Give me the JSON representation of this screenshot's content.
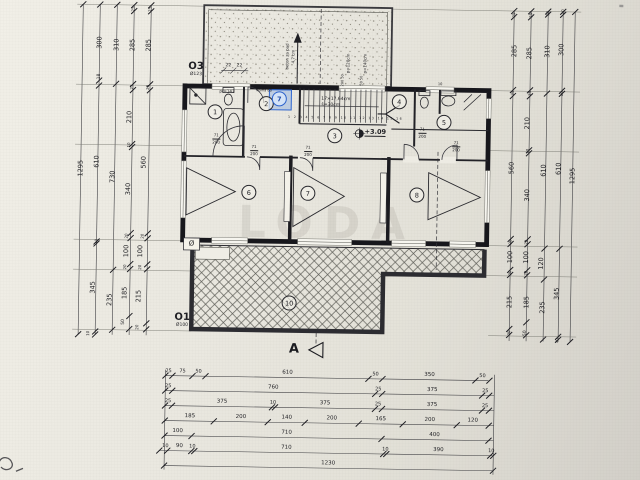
{
  "watermark": "LODA",
  "section_marker": "A",
  "openings": {
    "o3": {
      "label": "O3",
      "size": "Ø123"
    },
    "o1": {
      "label": "O1",
      "size": "Ø100"
    }
  },
  "plan_notes": {
    "stair_run": "17×17,64cm",
    "stair_width": "š=30cm",
    "elevation": "+3.09",
    "slope_note": "beton za pad 4,7 cm",
    "door_tag": "71/200"
  },
  "rooms": [
    {
      "n": "1",
      "x": 213,
      "y": 113
    },
    {
      "n": "2",
      "x": 264,
      "y": 104
    },
    {
      "n": "7",
      "x": 277,
      "y": 99,
      "sel": true
    },
    {
      "n": "3",
      "x": 333,
      "y": 135
    },
    {
      "n": "4",
      "x": 397,
      "y": 100
    },
    {
      "n": "5",
      "x": 442,
      "y": 120
    },
    {
      "n": "6",
      "x": 248,
      "y": 193
    },
    {
      "n": "7",
      "x": 307,
      "y": 193
    },
    {
      "n": "8",
      "x": 416,
      "y": 193
    },
    {
      "n": "10",
      "x": 290,
      "y": 303
    }
  ],
  "labels": [
    {
      "t": "1295",
      "x": 80,
      "y": 172,
      "o": "v"
    },
    {
      "t": "300",
      "x": 97,
      "y": 46,
      "o": "v"
    },
    {
      "t": "18",
      "x": 98,
      "y": 80,
      "o": "v",
      "fs": 4.5
    },
    {
      "t": "610",
      "x": 96,
      "y": 165,
      "o": "v"
    },
    {
      "t": "10",
      "x": 97,
      "y": 245,
      "o": "v",
      "fs": 4
    },
    {
      "t": "345",
      "x": 94,
      "y": 291,
      "o": "v"
    },
    {
      "t": "10",
      "x": 90,
      "y": 337,
      "o": "v",
      "fs": 4
    },
    {
      "t": "310",
      "x": 114,
      "y": 48,
      "o": "v"
    },
    {
      "t": "730",
      "x": 112,
      "y": 180,
      "o": "v"
    },
    {
      "t": "235",
      "x": 111,
      "y": 303,
      "o": "v"
    },
    {
      "t": "25",
      "x": 130,
      "y": 12,
      "o": "v",
      "fs": 4
    },
    {
      "t": "285",
      "x": 130,
      "y": 48,
      "o": "v"
    },
    {
      "t": "25",
      "x": 130,
      "y": 90,
      "o": "v",
      "fs": 4
    },
    {
      "t": "210",
      "x": 128,
      "y": 120,
      "o": "v"
    },
    {
      "t": "10",
      "x": 128,
      "y": 148,
      "o": "v",
      "fs": 4
    },
    {
      "t": "340",
      "x": 128,
      "y": 192,
      "o": "v"
    },
    {
      "t": "20",
      "x": 127,
      "y": 239,
      "o": "v",
      "fs": 4
    },
    {
      "t": "100",
      "x": 127,
      "y": 254,
      "o": "v"
    },
    {
      "t": "20",
      "x": 126,
      "y": 270,
      "o": "v",
      "fs": 4
    },
    {
      "t": "185",
      "x": 126,
      "y": 296,
      "o": "v"
    },
    {
      "t": "50",
      "x": 126,
      "y": 325,
      "o": "v",
      "fs": 4.5
    },
    {
      "t": "25",
      "x": 147,
      "y": 12,
      "o": "v",
      "fs": 4
    },
    {
      "t": "285",
      "x": 146,
      "y": 48,
      "o": "v"
    },
    {
      "t": "25",
      "x": 146,
      "y": 90,
      "o": "v",
      "fs": 4
    },
    {
      "t": "560",
      "x": 143,
      "y": 165,
      "o": "v"
    },
    {
      "t": "20",
      "x": 143,
      "y": 239,
      "o": "v",
      "fs": 4
    },
    {
      "t": "100",
      "x": 141,
      "y": 254,
      "o": "v"
    },
    {
      "t": "20",
      "x": 141,
      "y": 270,
      "o": "v",
      "fs": 4
    },
    {
      "t": "215",
      "x": 140,
      "y": 299,
      "o": "v"
    },
    {
      "t": "20",
      "x": 139,
      "y": 330,
      "o": "v",
      "fs": 4
    },
    {
      "t": "25",
      "x": 511,
      "y": 12,
      "o": "v",
      "fs": 4
    },
    {
      "t": "285",
      "x": 512,
      "y": 48,
      "o": "v"
    },
    {
      "t": "25",
      "x": 511,
      "y": 90,
      "o": "v",
      "fs": 4
    },
    {
      "t": "560",
      "x": 511,
      "y": 165,
      "o": "v"
    },
    {
      "t": "20",
      "x": 511,
      "y": 239,
      "o": "v",
      "fs": 4
    },
    {
      "t": "100",
      "x": 511,
      "y": 254,
      "o": "v"
    },
    {
      "t": "20",
      "x": 511,
      "y": 270,
      "o": "v",
      "fs": 4
    },
    {
      "t": "215",
      "x": 511,
      "y": 299,
      "o": "v"
    },
    {
      "t": "20",
      "x": 511,
      "y": 330,
      "o": "v",
      "fs": 4
    },
    {
      "t": "25",
      "x": 528,
      "y": 12,
      "o": "v",
      "fs": 4
    },
    {
      "t": "285",
      "x": 527,
      "y": 50,
      "o": "v"
    },
    {
      "t": "25",
      "x": 528,
      "y": 90,
      "o": "v",
      "fs": 4
    },
    {
      "t": "210",
      "x": 526,
      "y": 120,
      "o": "v"
    },
    {
      "t": "10",
      "x": 527,
      "y": 148,
      "o": "v",
      "fs": 4
    },
    {
      "t": "340",
      "x": 527,
      "y": 192,
      "o": "v"
    },
    {
      "t": "20",
      "x": 527,
      "y": 239,
      "o": "v",
      "fs": 4
    },
    {
      "t": "100",
      "x": 527,
      "y": 254,
      "o": "v"
    },
    {
      "t": "20",
      "x": 527,
      "y": 270,
      "o": "v",
      "fs": 4
    },
    {
      "t": "185",
      "x": 528,
      "y": 299,
      "o": "v"
    },
    {
      "t": "50",
      "x": 528,
      "y": 330,
      "o": "v",
      "fs": 4.5
    },
    {
      "t": "10",
      "x": 545,
      "y": 10,
      "o": "v",
      "fs": 4
    },
    {
      "t": "310",
      "x": 545,
      "y": 48,
      "o": "v"
    },
    {
      "t": "610",
      "x": 543,
      "y": 167,
      "o": "v"
    },
    {
      "t": "120",
      "x": 542,
      "y": 260,
      "o": "v"
    },
    {
      "t": "235",
      "x": 544,
      "y": 304,
      "o": "v"
    },
    {
      "t": "10",
      "x": 560,
      "y": 8,
      "o": "v",
      "fs": 4
    },
    {
      "t": "300",
      "x": 559,
      "y": 46,
      "o": "v"
    },
    {
      "t": "10",
      "x": 560,
      "y": 90,
      "o": "v",
      "fs": 4
    },
    {
      "t": "610",
      "x": 558,
      "y": 165,
      "o": "v"
    },
    {
      "t": "345",
      "x": 558,
      "y": 290,
      "o": "v"
    },
    {
      "t": "10",
      "x": 559,
      "y": 337,
      "o": "v",
      "fs": 4
    },
    {
      "t": "1295",
      "x": 572,
      "y": 172,
      "o": "v"
    },
    {
      "t": "25",
      "x": 171,
      "y": 374,
      "fs": 5
    },
    {
      "t": "75",
      "x": 185,
      "y": 374,
      "fs": 5
    },
    {
      "t": "50",
      "x": 201,
      "y": 374,
      "fs": 5
    },
    {
      "t": "610",
      "x": 290,
      "y": 374,
      "fs": 5.5
    },
    {
      "t": "50",
      "x": 378,
      "y": 374,
      "fs": 5
    },
    {
      "t": "350",
      "x": 432,
      "y": 374,
      "fs": 5.5
    },
    {
      "t": "50",
      "x": 485,
      "y": 374,
      "fs": 5
    },
    {
      "t": "25",
      "x": 171,
      "y": 389,
      "fs": 5
    },
    {
      "t": "760",
      "x": 276,
      "y": 389,
      "fs": 5.5
    },
    {
      "t": "25",
      "x": 381,
      "y": 389,
      "fs": 5
    },
    {
      "t": "375",
      "x": 435,
      "y": 389,
      "fs": 5.5
    },
    {
      "t": "25",
      "x": 488,
      "y": 389,
      "fs": 5
    },
    {
      "t": "25",
      "x": 171,
      "y": 404,
      "fs": 5
    },
    {
      "t": "375",
      "x": 225,
      "y": 404,
      "fs": 5.5
    },
    {
      "t": "10",
      "x": 276,
      "y": 404,
      "fs": 5
    },
    {
      "t": "375",
      "x": 328,
      "y": 404,
      "fs": 5.5
    },
    {
      "t": "25",
      "x": 381,
      "y": 404,
      "fs": 5
    },
    {
      "t": "375",
      "x": 435,
      "y": 404,
      "fs": 5.5
    },
    {
      "t": "25",
      "x": 488,
      "y": 404,
      "fs": 5
    },
    {
      "t": "185",
      "x": 193,
      "y": 419,
      "fs": 5.5
    },
    {
      "t": "200",
      "x": 244,
      "y": 419,
      "fs": 5.5
    },
    {
      "t": "140",
      "x": 290,
      "y": 419,
      "fs": 5.5
    },
    {
      "t": "200",
      "x": 335,
      "y": 419,
      "fs": 5.5
    },
    {
      "t": "165",
      "x": 384,
      "y": 419,
      "fs": 5.5
    },
    {
      "t": "200",
      "x": 433,
      "y": 419,
      "fs": 5.5
    },
    {
      "t": "120",
      "x": 476,
      "y": 419,
      "fs": 5.5
    },
    {
      "t": "100",
      "x": 181,
      "y": 434,
      "fs": 5.5
    },
    {
      "t": "710",
      "x": 290,
      "y": 434,
      "fs": 5.5
    },
    {
      "t": "400",
      "x": 438,
      "y": 434,
      "fs": 5.5
    },
    {
      "t": "10",
      "x": 169,
      "y": 449,
      "fs": 5
    },
    {
      "t": "90",
      "x": 183,
      "y": 449,
      "fs": 5.5
    },
    {
      "t": "10",
      "x": 196,
      "y": 449,
      "fs": 5
    },
    {
      "t": "710",
      "x": 290,
      "y": 449,
      "fs": 5.5
    },
    {
      "t": "10",
      "x": 389,
      "y": 449,
      "fs": 5
    },
    {
      "t": "390",
      "x": 442,
      "y": 449,
      "fs": 5.5
    },
    {
      "t": "10",
      "x": 495,
      "y": 449,
      "fs": 5
    },
    {
      "t": "1230",
      "x": 332,
      "y": 464,
      "fs": 5.5
    },
    {
      "t": "pr=143",
      "x": 225,
      "y": 93,
      "fs": 4
    },
    {
      "t": "visina 80",
      "x": 262,
      "y": 92,
      "fs": 3.5
    },
    {
      "t": "22",
      "x": 226,
      "y": 68,
      "fs": 4.5
    },
    {
      "t": "22",
      "x": 237,
      "y": 68,
      "fs": 4.5
    },
    {
      "t": "beton za pad",
      "x": 285,
      "y": 57,
      "o": "v",
      "fs": 4
    },
    {
      "t": "4,7 cm",
      "x": 291,
      "y": 57,
      "o": "v",
      "fs": 4
    },
    {
      "t": "p=120cm",
      "x": 346,
      "y": 63,
      "o": "v",
      "fs": 4
    },
    {
      "t": "200 50",
      "x": 341,
      "y": 80,
      "o": "v",
      "fs": 3.5
    },
    {
      "t": "p=140cm",
      "x": 363,
      "y": 63,
      "o": "v",
      "fs": 4
    },
    {
      "t": "50 50",
      "x": 360,
      "y": 80,
      "o": "v",
      "fs": 3.5
    },
    {
      "t": "17×17,64cm",
      "x": 334,
      "y": 100,
      "fs": 4.5
    },
    {
      "t": "š=30cm",
      "x": 329,
      "y": 106,
      "fs": 4.5
    },
    {
      "t": "1 2 3 4 5 6 7 8 9 10 11 12 13 14 15 16",
      "x": 344,
      "y": 118,
      "fs": 3.2,
      "c": "st"
    },
    {
      "t": "+3.09",
      "x": 374,
      "y": 132,
      "fs": 6.5,
      "c": "el"
    },
    {
      "t": "71",
      "x": 215,
      "y": 137,
      "fs": 4
    },
    {
      "t": "200",
      "x": 215,
      "y": 143,
      "fs": 4,
      "c": "fr"
    },
    {
      "t": "71",
      "x": 253,
      "y": 148,
      "fs": 4
    },
    {
      "t": "200",
      "x": 253,
      "y": 154,
      "fs": 4,
      "c": "fr"
    },
    {
      "t": "71",
      "x": 307,
      "y": 148,
      "fs": 4
    },
    {
      "t": "200",
      "x": 307,
      "y": 154,
      "fs": 4,
      "c": "fr"
    },
    {
      "t": "71",
      "x": 421,
      "y": 128,
      "fs": 4
    },
    {
      "t": "200",
      "x": 421,
      "y": 134,
      "fs": 4,
      "c": "fr"
    },
    {
      "t": "71",
      "x": 455,
      "y": 141,
      "fs": 4
    },
    {
      "t": "200",
      "x": 455,
      "y": 147,
      "fs": 4,
      "c": "fr"
    },
    {
      "t": "Ø",
      "x": 192,
      "y": 246,
      "fs": 7
    },
    {
      "t": "10",
      "x": 438,
      "y": 83,
      "fs": 3.5
    }
  ]
}
